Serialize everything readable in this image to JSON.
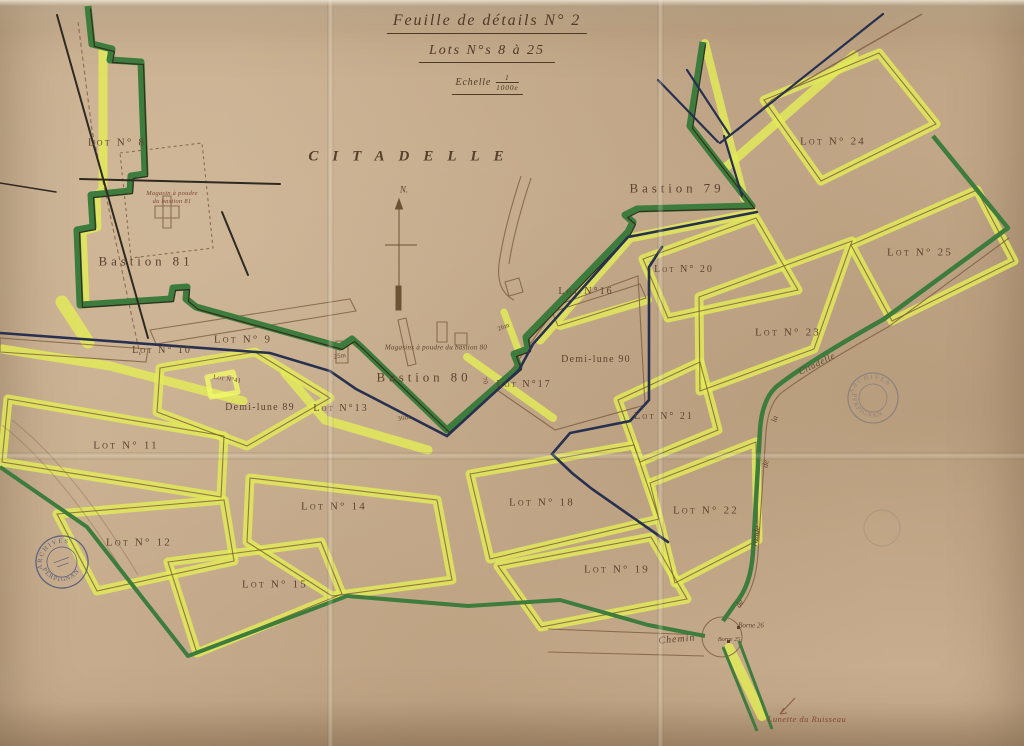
{
  "title_block": {
    "title": "Feuille de détails N° 2",
    "subtitle": "Lots N°s 8 à 25",
    "scale_word": "Echelle",
    "scale_numerator": "1",
    "scale_denominator": "1000e"
  },
  "map": {
    "region_label": "CITADELLE",
    "north_label": "N.",
    "bastions": {
      "b79": "Bastion 79",
      "b80": "Bastion 80",
      "b81": "Bastion 81"
    },
    "demilunes": {
      "d89": "Demi-lune 89",
      "d90": "Demi-lune 90"
    },
    "magazines": {
      "m81_line1": "Magasin à poudre",
      "m81_line2": "du bastion 81",
      "m80": "Magasins à poudre du bastion 80"
    },
    "lots": {
      "lot8": "Lot N° 8",
      "lot9": "Lot N° 9",
      "lot10": "Lot N° 10",
      "lot11": "Lot N° 11",
      "lot12": "Lot N° 12",
      "lot13": "Lot N°13",
      "lot14": "Lot N° 14",
      "lot15": "Lot N° 15",
      "lot16": "Lot N°16",
      "lot17": "Lot N°17",
      "lot18": "Lot N° 18",
      "lot19": "Lot N° 19",
      "lot20": "Lot N° 20",
      "lot21": "Lot N° 21",
      "lot22": "Lot N° 22",
      "lot23": "Lot N° 23",
      "lot24": "Lot N° 24",
      "lot25": "Lot N° 25",
      "lot41": "Lot N°41"
    },
    "roads": {
      "chemin": "Chemin",
      "de1": "de",
      "ronde": "ronde",
      "de2": "de",
      "la": "la",
      "citadelle": "Citadelle"
    },
    "bornes": {
      "b26": "Borne 26",
      "b25": "Borne 25"
    },
    "features": {
      "lunette": "Lunette du Ruisseau"
    },
    "measurements": {
      "m25": "25m",
      "m26": "26m",
      "m30": "30m",
      "m70": "70"
    },
    "stamps": {
      "top": "ARCHIVES",
      "bottom": "PERPIGNAN"
    }
  },
  "colors": {
    "paper": "#c8ae8e",
    "rampart_green": "#3e7c3d",
    "lot_yellow": "#e3ec58",
    "ink_navy": "#27304f",
    "ink_brown": "#7a5a3c",
    "label_brown": "#5d4330",
    "stamp_blue": "#3c4a74"
  }
}
